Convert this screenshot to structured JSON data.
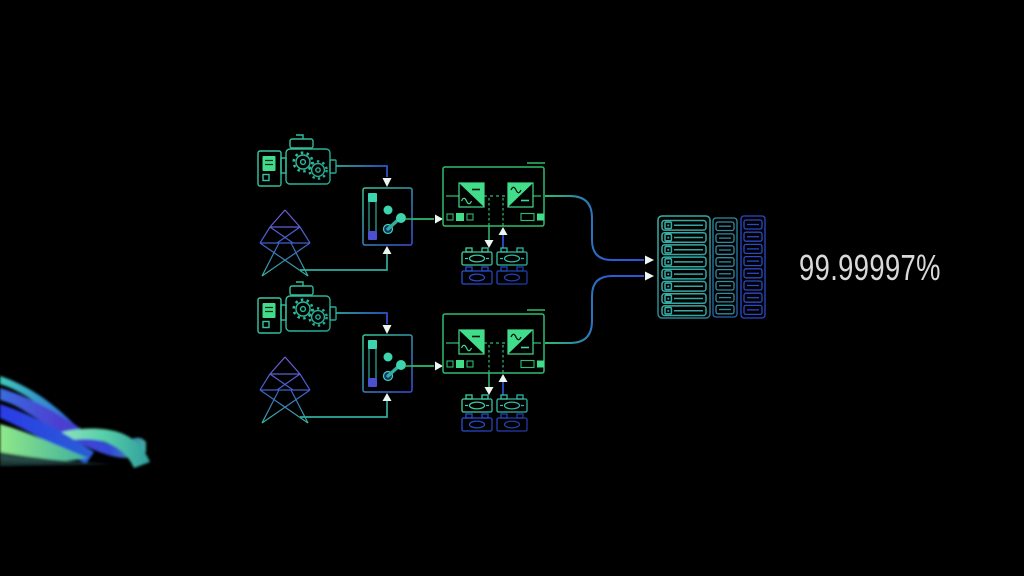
{
  "page": {
    "type": "datacenter-power-redundancy-diagram",
    "background": "#000000"
  },
  "availability": {
    "value": "99.99997%",
    "color": "#d9d9d9"
  },
  "colors": {
    "green": "#2dbd6e",
    "bright_green": "#42dd8a",
    "teal": "#2fae9e",
    "blue": "#2b4fd4",
    "indigo": "#5a4fd4",
    "rack_teal": "#2f8fa0",
    "rack_blue": "#2b49c8",
    "arrow_white": "#eef6f0",
    "wave_palette": [
      "#3fc9b8",
      "#4b3fd0",
      "#2b3be8",
      "#8fe889"
    ]
  },
  "icons": {
    "generator": "generator-icon",
    "utility_power": "utility-tower-icon",
    "transfer_switch": "transfer-switch-icon",
    "ups": "ups-icon",
    "batteries": "battery-bank-icon",
    "server_racks": "server-rack-icon",
    "decorative": "gradient-wave"
  },
  "diagram": {
    "paths": [
      {
        "id": "power-path-a",
        "components": [
          "generator",
          "utility-tower",
          "transfer-switch",
          "ups",
          "battery-bank"
        ]
      },
      {
        "id": "power-path-b",
        "components": [
          "generator",
          "utility-tower",
          "transfer-switch",
          "ups",
          "battery-bank"
        ]
      }
    ],
    "destination": "server-racks"
  }
}
